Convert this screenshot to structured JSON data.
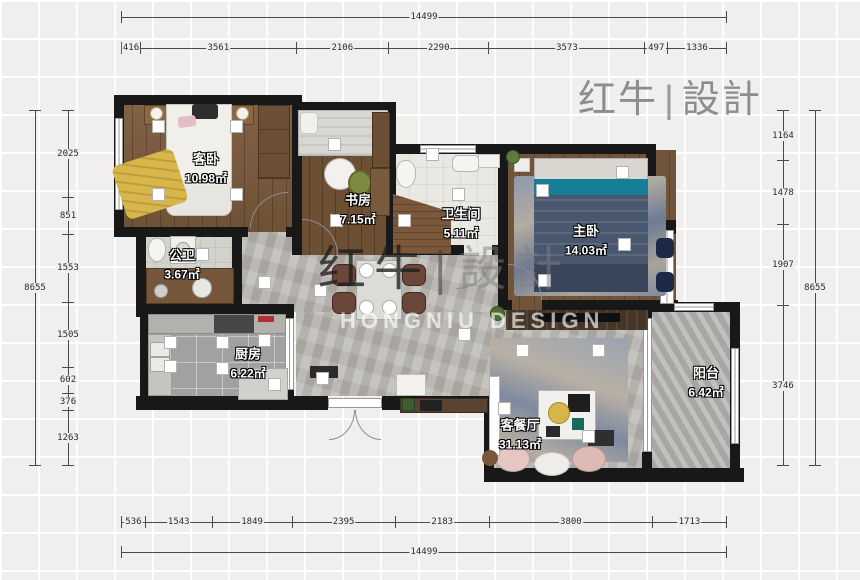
{
  "logo": {
    "cn1": "红牛",
    "bar": "|",
    "cn2": "設計"
  },
  "watermark": {
    "cn1": "红牛",
    "bar": "|",
    "cn2": "設計",
    "en": "HONGNIU DESIGN"
  },
  "rooms": [
    {
      "id": "guest-bedroom",
      "label": "客卧",
      "area": "10.98㎡"
    },
    {
      "id": "study",
      "label": "书房",
      "area": "7.15㎡"
    },
    {
      "id": "bathroom",
      "label": "卫生间",
      "area": "5.11㎡"
    },
    {
      "id": "master-bedroom",
      "label": "主卧",
      "area": "14.03㎡"
    },
    {
      "id": "guest-wc",
      "label": "公卫",
      "area": "3.67㎡"
    },
    {
      "id": "kitchen",
      "label": "厨房",
      "area": "6.22㎡"
    },
    {
      "id": "living-dining",
      "label": "客餐厅",
      "area": "31.13㎡"
    },
    {
      "id": "balcony",
      "label": "阳台",
      "area": "6.42㎡"
    }
  ],
  "dimensions": {
    "top_total": {
      "values": [
        14499
      ]
    },
    "top_segments": {
      "values": [
        416,
        3561,
        2106,
        2290,
        3573,
        497,
        1336
      ]
    },
    "bottom_segments": {
      "values": [
        536,
        1543,
        1849,
        2395,
        2183,
        3800,
        1713
      ]
    },
    "bottom_total": {
      "values": [
        14499
      ]
    },
    "left_total": {
      "values": [
        8655
      ]
    },
    "left_segments": {
      "values": [
        2025,
        851,
        1553,
        1505,
        602,
        376,
        1263
      ]
    },
    "right_segments": {
      "values": [
        1164,
        1478,
        1907,
        3746
      ]
    },
    "right_total": {
      "values": [
        8655
      ]
    }
  },
  "colors": {
    "wall": "#181818",
    "background": "#f0efed",
    "wood_floor": "#7b5a3c",
    "concrete_floor": "#b8b5b0",
    "accent_teal": "#177e97",
    "accent_yellow": "#d7b64b",
    "logo_gray": "#8d8d8d"
  }
}
